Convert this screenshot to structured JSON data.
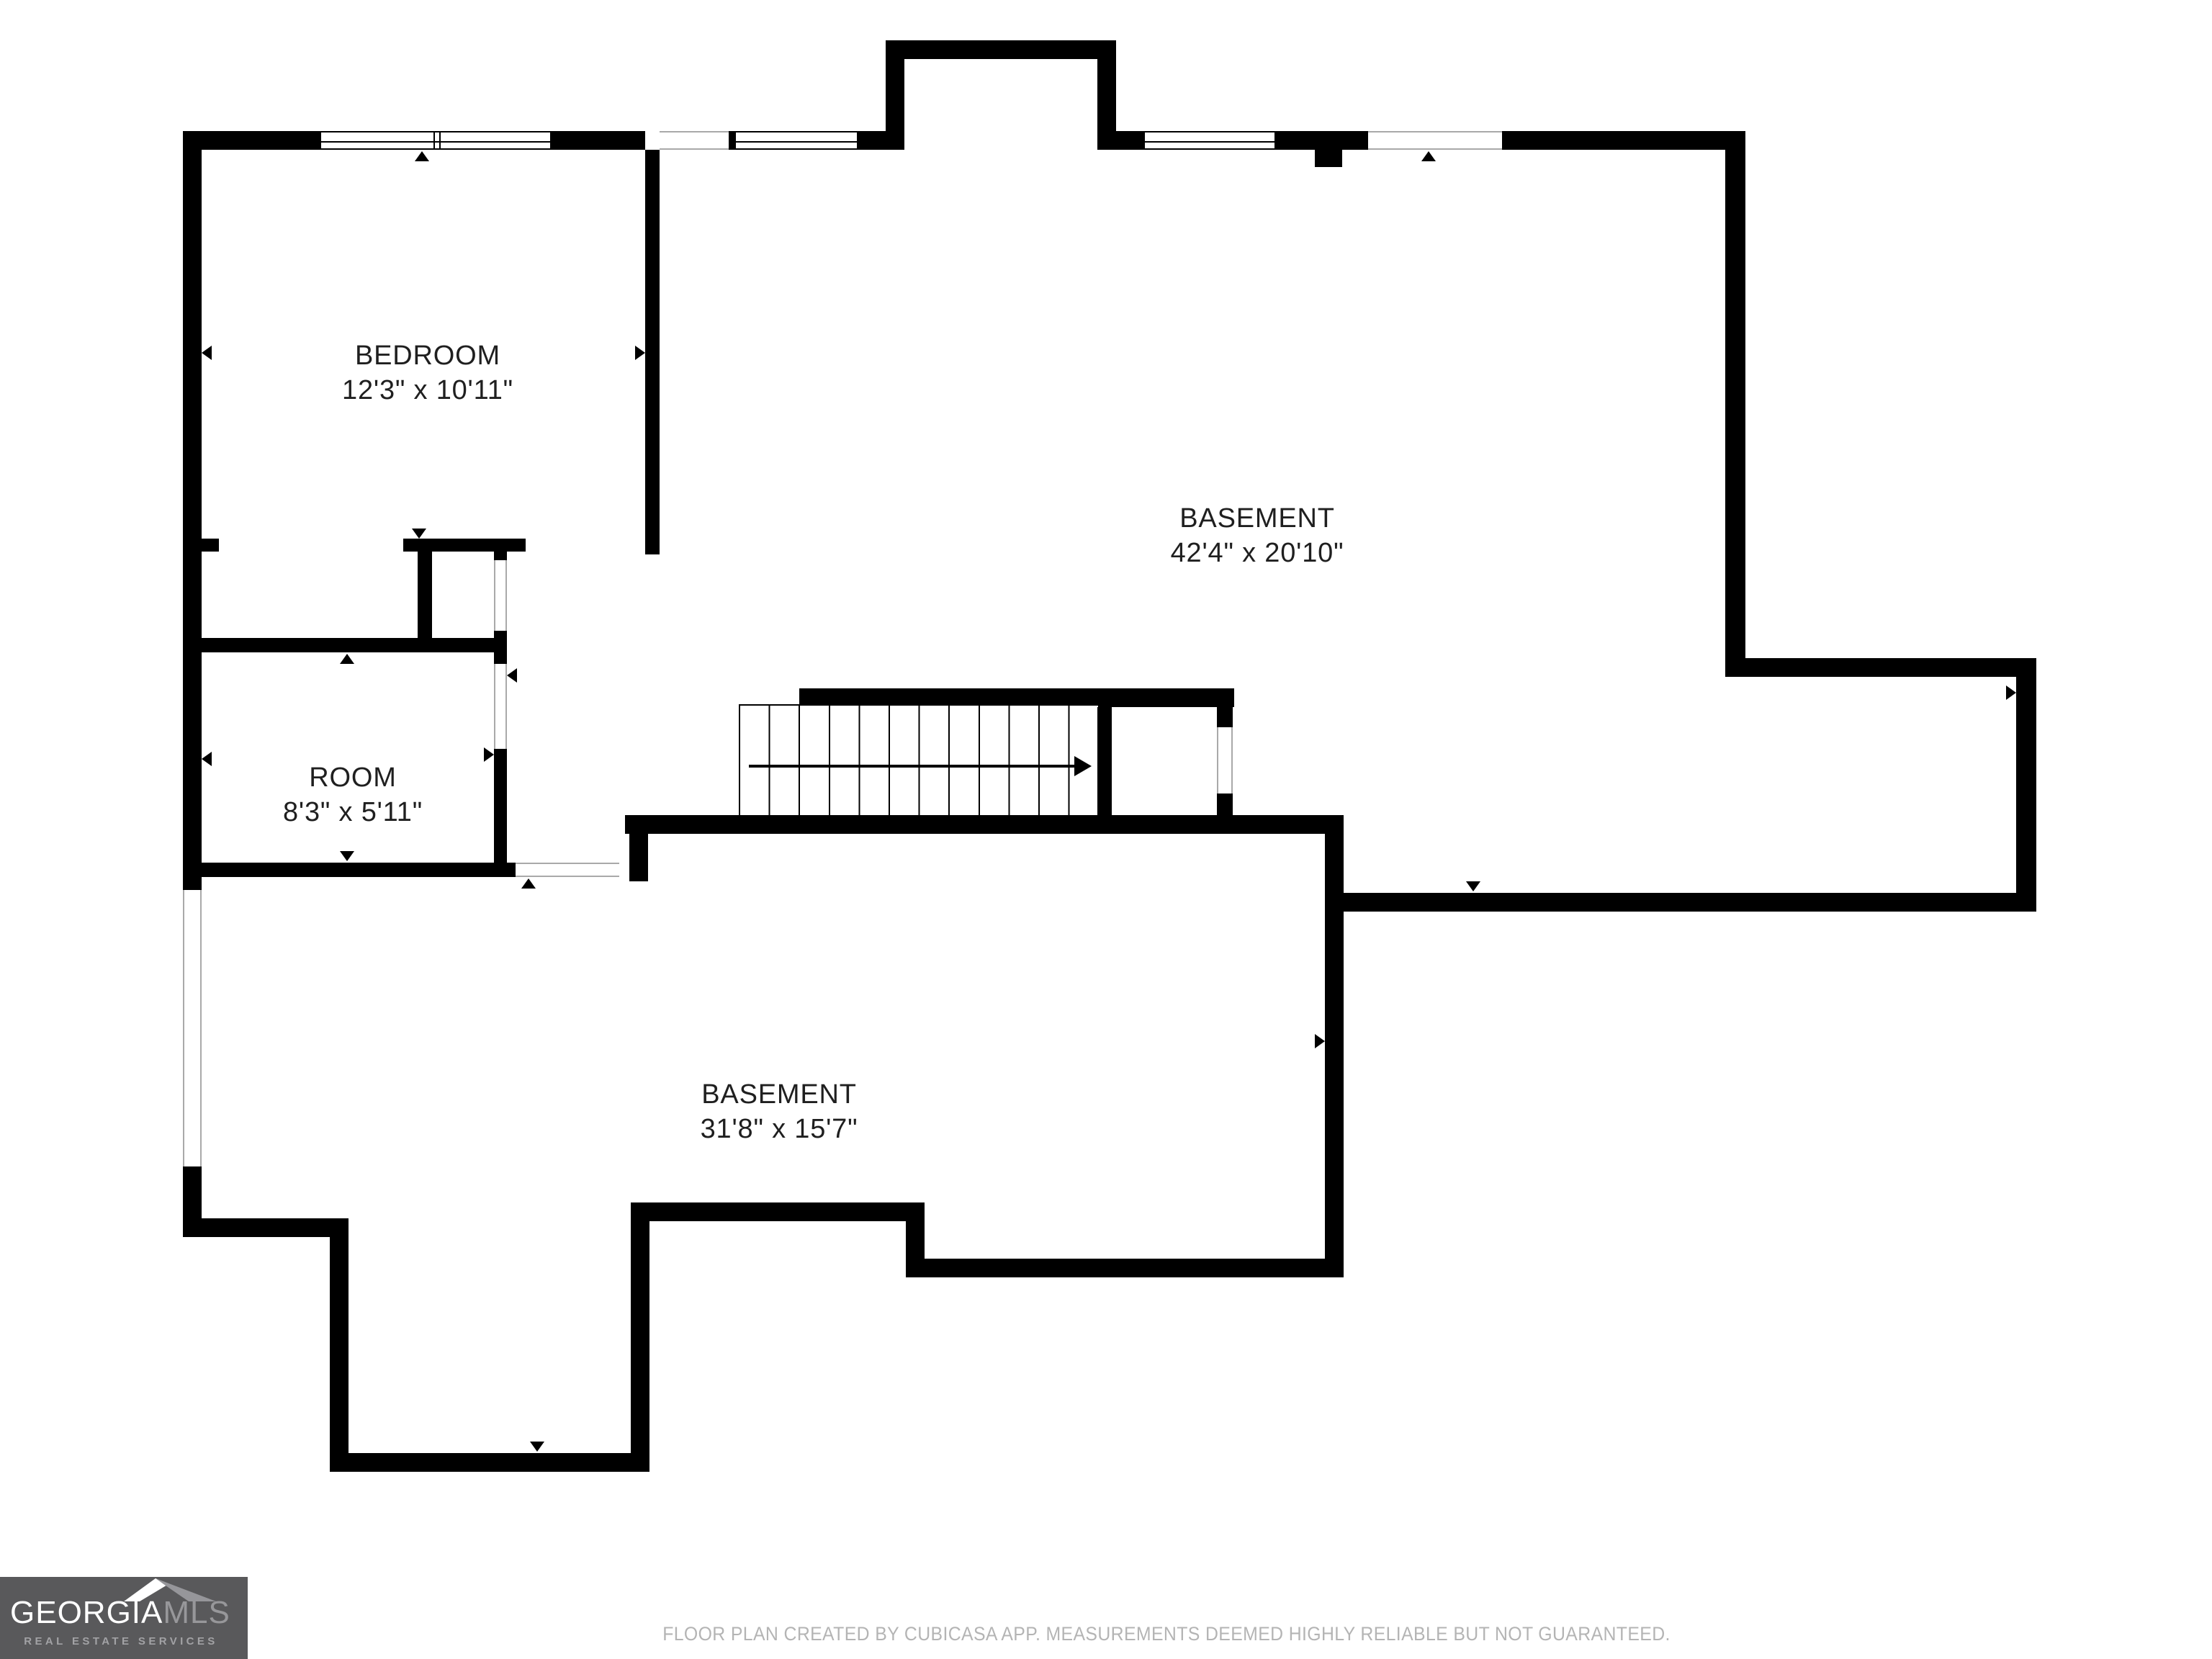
{
  "plan": {
    "rooms": [
      {
        "key": "bedroom",
        "label": "BEDROOM",
        "dims": "12'3\" x 10'11\""
      },
      {
        "key": "basement-upper",
        "label": "BASEMENT",
        "dims": "42'4\" x 20'10\""
      },
      {
        "key": "room",
        "label": "ROOM",
        "dims": "8'3\" x 5'11\""
      },
      {
        "key": "basement-lower",
        "label": "BASEMENT",
        "dims": "31'8\" x 15'7\""
      }
    ],
    "stair_direction": "right"
  },
  "footer": {
    "disclaimer": "FLOOR PLAN CREATED BY CUBICASA APP. MEASUREMENTS DEEMED HIGHLY RELIABLE BUT NOT GUARANTEED."
  },
  "logo": {
    "brand": "GEORGIA",
    "brand_suffix": "MLS",
    "tagline": "REAL ESTATE SERVICES"
  },
  "colors": {
    "wall": "#000000",
    "background": "#ffffff",
    "label_text": "#1f1f1f",
    "footer_text": "#b4b4b4",
    "logo_background": "#59595b",
    "logo_brand": "#ffffff",
    "logo_brand_suffix": "#97979a"
  }
}
